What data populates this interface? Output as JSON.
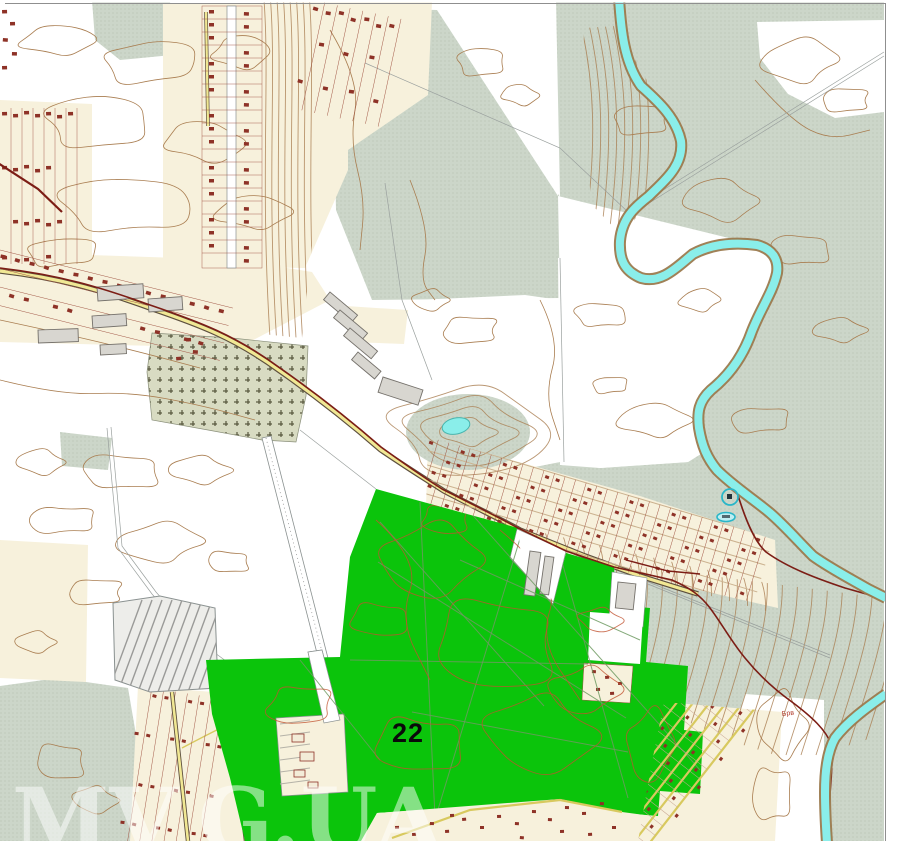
{
  "title": "Topographic cadastral map with highlighted parcel",
  "map": {
    "parcel_label": "22",
    "micro_label": "Брв",
    "watermark_left": "MV",
    "watermark_right": "G.UA"
  },
  "palette": {
    "highlight_green": "#0bc40b",
    "water_cyan": "#8aeeea",
    "vegetation_gray_green": "#ccd6c9",
    "field_cream": "#f7f1dc",
    "contour_brown": "#a97d50",
    "building_maroon": "#8e3227",
    "boundary_dark_red": "#7c1d15",
    "road_yellow": "#f1e894",
    "watermark_white": "#ffffff"
  }
}
